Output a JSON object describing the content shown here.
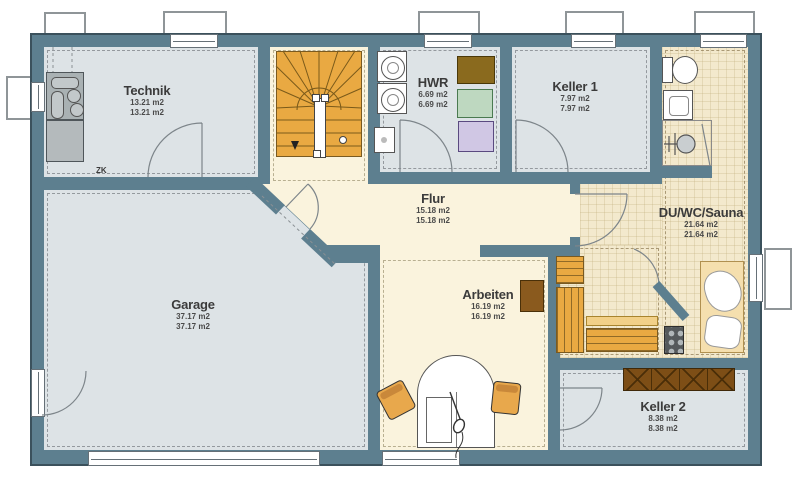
{
  "plan": {
    "title": "Kellergeschoss Grundriss",
    "rooms": {
      "technik": {
        "name": "Technik",
        "area1": "13.21 m2",
        "area2": "13.21 m2"
      },
      "hwr": {
        "name": "HWR",
        "area1": "6.69 m2",
        "area2": "6.69 m2"
      },
      "keller1": {
        "name": "Keller 1",
        "area1": "7.97 m2",
        "area2": "7.97 m2"
      },
      "flur": {
        "name": "Flur",
        "area1": "15.18 m2",
        "area2": "15.18 m2"
      },
      "duwcsauna": {
        "name": "DU/WC/Sauna",
        "area1": "21.64 m2",
        "area2": "21.64 m2"
      },
      "garage": {
        "name": "Garage",
        "area1": "37.17 m2",
        "area2": "37.17 m2"
      },
      "arbeiten": {
        "name": "Arbeiten",
        "area1": "16.19 m2",
        "area2": "16.19 m2"
      },
      "keller2": {
        "name": "Keller 2",
        "area1": "8.38 m2",
        "area2": "8.38 m2"
      }
    },
    "annotations": {
      "zk": "ZK"
    },
    "icons": [
      "stairs-icon",
      "washing-machine-icon",
      "dryer-icon",
      "sink-icon",
      "toilet-icon",
      "shower-icon",
      "sauna-bench-icon",
      "sauna-heater-icon",
      "lounger-icon",
      "desk-icon",
      "office-chair-icon",
      "cabinet-icon",
      "heating-unit-icon"
    ],
    "colors": {
      "wall": "#5d7f8f",
      "floorGray": "#dde3e6",
      "floorCream": "#faf3dd",
      "floorTile": "#f3e9cd",
      "wood": "#e9a942",
      "woodLight": "#f2d088",
      "brown": "#7d4e16",
      "brownCab": "#8a5a1e",
      "chair": "#e8a84c"
    }
  }
}
